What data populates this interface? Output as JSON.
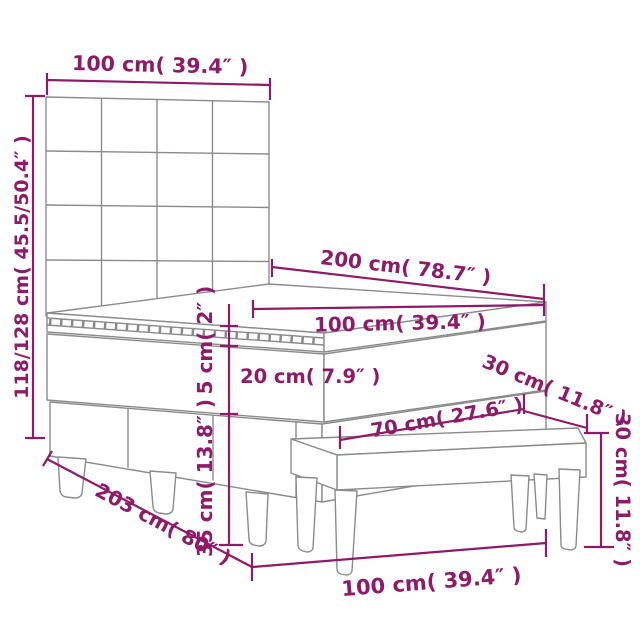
{
  "diagram": {
    "type": "product-dimension-diagram",
    "subject": "box spring bed with tufted headboard, mattress topper and bench",
    "accent_color": "#8e1a68",
    "lineart_color": "#8b8b8b",
    "background_color": "#ffffff",
    "dimensions": {
      "headboard_width": "100 cm( 39.4″ )",
      "total_height": "118/128 cm( 45.5/50.4″ )",
      "bed_length": "200 cm( 78.7″ )",
      "mattress_width": "100 cm( 39.4″ )",
      "topper_height": "5 cm( 2″ )",
      "mattress_height": "20 cm( 7.9″ )",
      "bench_depth": "30 cm( 11.8″ )",
      "bench_seat_width": "70 cm( 27.6″ )",
      "bench_height": "30 cm( 11.8″ )",
      "base_height": "35 cm( 13.8″ )",
      "base_length": "203 cm( 80″ )",
      "bench_length": "100 cm( 39.4″ )"
    }
  }
}
